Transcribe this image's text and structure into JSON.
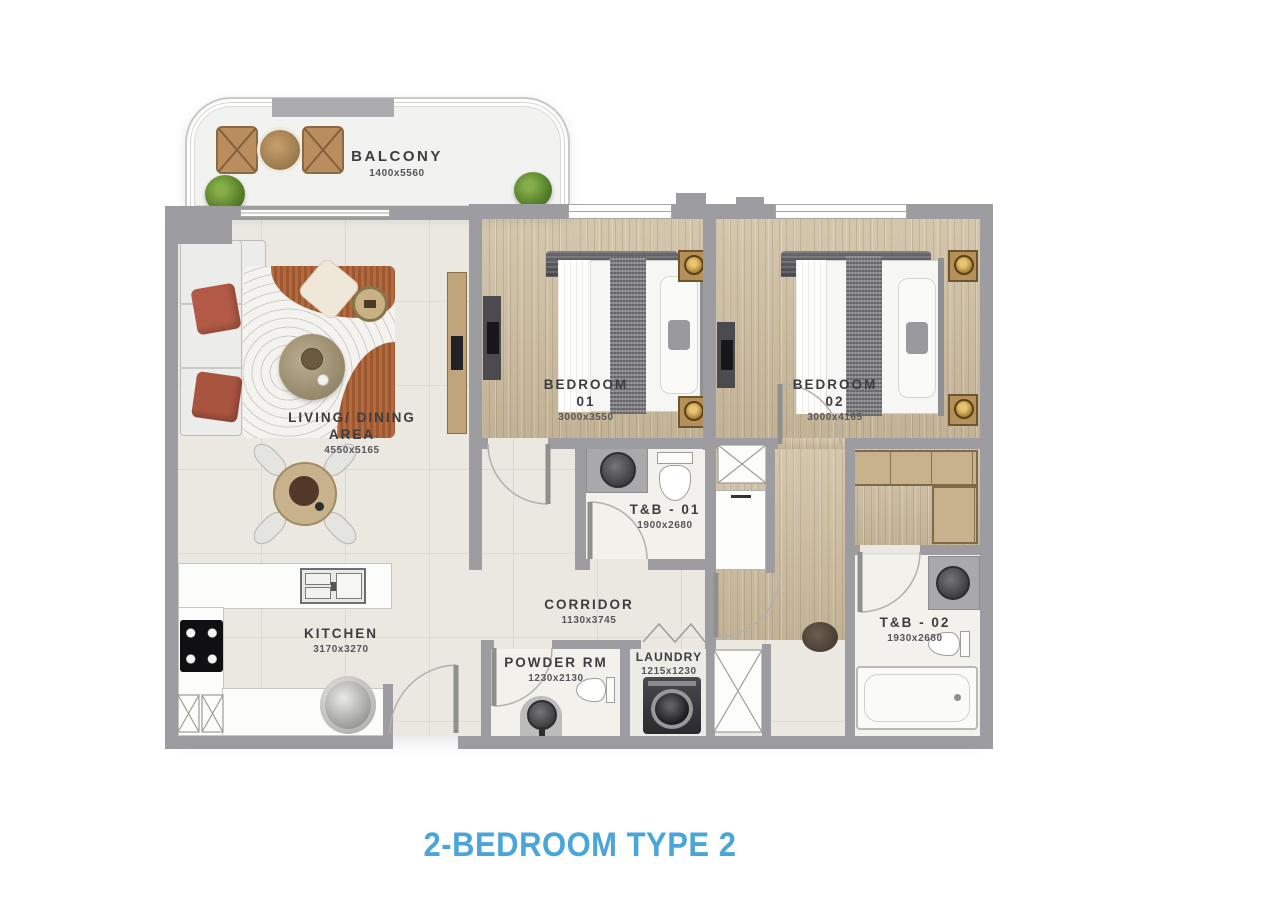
{
  "title": {
    "text": "2-BEDROOM TYPE 2"
  },
  "colors": {
    "title_blue": "#4AA5DA",
    "wall_gray": "#9D9DA1",
    "floor_cream": "#EAE8E1",
    "wood_floor": "#D0C1A5",
    "rug_orange": "#B5693C",
    "label_ink": "#3D3D40"
  },
  "rooms": {
    "balcony": {
      "name": "BALCONY",
      "dims": "1400x5560"
    },
    "living_dining": {
      "name_line1": "LIVING/ DINING",
      "name_line2": "AREA",
      "dims": "4550x5165"
    },
    "bedroom_01": {
      "name": "BEDROOM",
      "number": "01",
      "dims": "3000x3550"
    },
    "bedroom_02": {
      "name": "BEDROOM",
      "number": "02",
      "dims": "3000x4165"
    },
    "toilet_bath_01": {
      "name": "T&B - 01",
      "dims": "1900x2680"
    },
    "corridor": {
      "name": "CORRIDOR",
      "dims": "1130x3745"
    },
    "kitchen": {
      "name": "KITCHEN",
      "dims": "3170x3270"
    },
    "powder_room": {
      "name": "POWDER RM",
      "dims": "1230x2130"
    },
    "laundry": {
      "name": "LAUNDRY",
      "dims": "1215x1230"
    },
    "toilet_bath_02": {
      "name": "T&B - 02",
      "dims": "1930x2680"
    }
  }
}
